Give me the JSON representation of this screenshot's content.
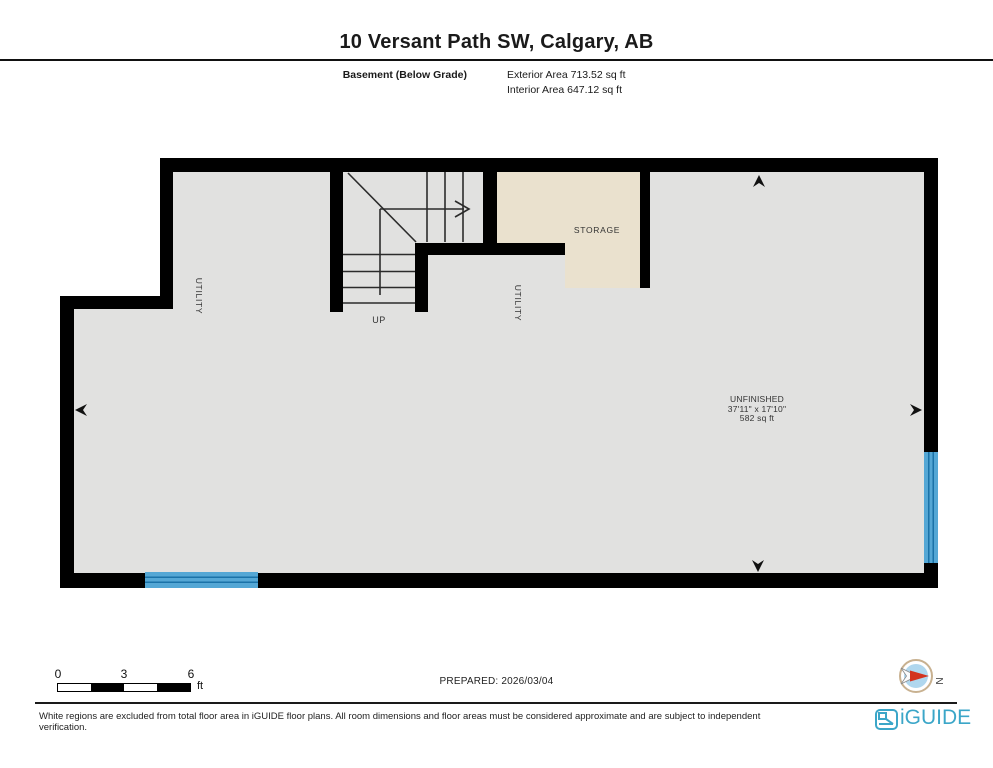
{
  "header": {
    "title": "10 Versant Path SW, Calgary, AB",
    "floor_label": "Basement (Below Grade)",
    "exterior_area": "Exterior Area 713.52 sq ft",
    "interior_area": "Interior Area 647.12 sq ft"
  },
  "plan": {
    "labels": {
      "utility_left": "UTILITY",
      "utility_right": "UTILITY",
      "storage": "STORAGE",
      "up": "UP",
      "unfinished_name": "UNFINISHED",
      "unfinished_dims": "37'11\" x 17'10\"",
      "unfinished_area": "582 sq ft"
    },
    "colors": {
      "wall": "#000000",
      "floor": "#e1e1e0",
      "storage_fill": "#eae1ce",
      "window_blue": "#54a7d5",
      "window_stripe": "#1a72a8"
    }
  },
  "scale_bar": {
    "ticks": [
      "0",
      "3",
      "6"
    ],
    "unit": "ft"
  },
  "prepared": "PREPARED: 2026/03/04",
  "compass": {
    "label": "N",
    "ring_color": "#c8b190",
    "disc_color": "#b0d7ee",
    "needle_red": "#d3331f"
  },
  "footer": {
    "disclaimer": "White regions are excluded from total floor area in iGUIDE floor plans. All room dimensions and floor areas must be considered approximate and are subject to independent verification.",
    "brand": "iGUIDE",
    "brand_color": "#3ba6c8"
  }
}
